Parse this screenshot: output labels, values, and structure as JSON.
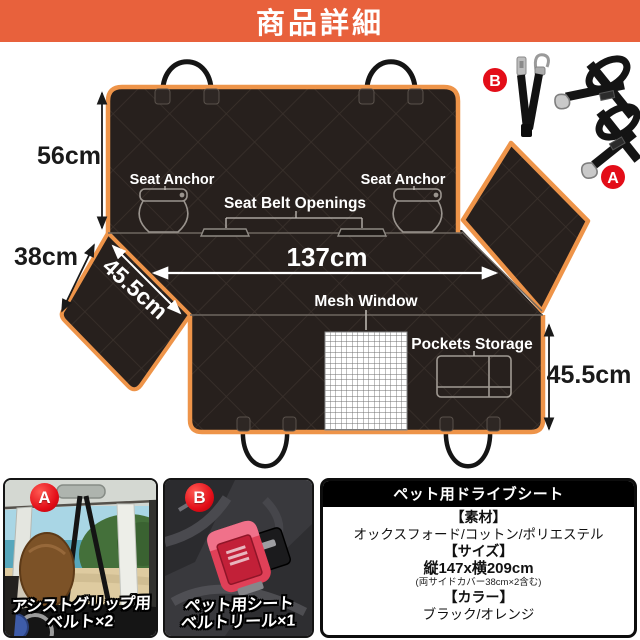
{
  "banner": {
    "title": "商品詳細"
  },
  "diagram": {
    "back_height": "56cm",
    "side_width": "38cm",
    "side_depth": "45.5cm",
    "seat_width": "137cm",
    "front_depth": "45.5cm",
    "seat_anchor_left": "Seat Anchor",
    "seat_anchor_right": "Seat Anchor",
    "seat_belt_openings": "Seat Belt Openings",
    "mesh_window": "Mesh Window",
    "pockets_storage": "Pockets Storage",
    "badge_a": "A",
    "badge_b": "B"
  },
  "panels": {
    "a": {
      "badge": "A",
      "caption_line1": "アシストグリップ用",
      "caption_line2": "ベルト×2"
    },
    "b": {
      "badge": "B",
      "caption_line1": "ペット用シート",
      "caption_line2": "ベルトリール×1"
    },
    "info": {
      "title": "ペット用ドライブシート",
      "material_header": "【素材】",
      "material": "オックスフォード/コットン/ポリエステル",
      "size_header": "【サイズ】",
      "size": "縦147x横209cm",
      "size_note": "(両サイドカバー38cm×2含む)",
      "color_header": "【カラー】",
      "color": "ブラック/オレンジ"
    }
  },
  "colors": {
    "banner_red": "#E8613C",
    "trim_orange": "#EE9449",
    "cover_black": "#27201D",
    "badge_red": "#E30D18"
  }
}
